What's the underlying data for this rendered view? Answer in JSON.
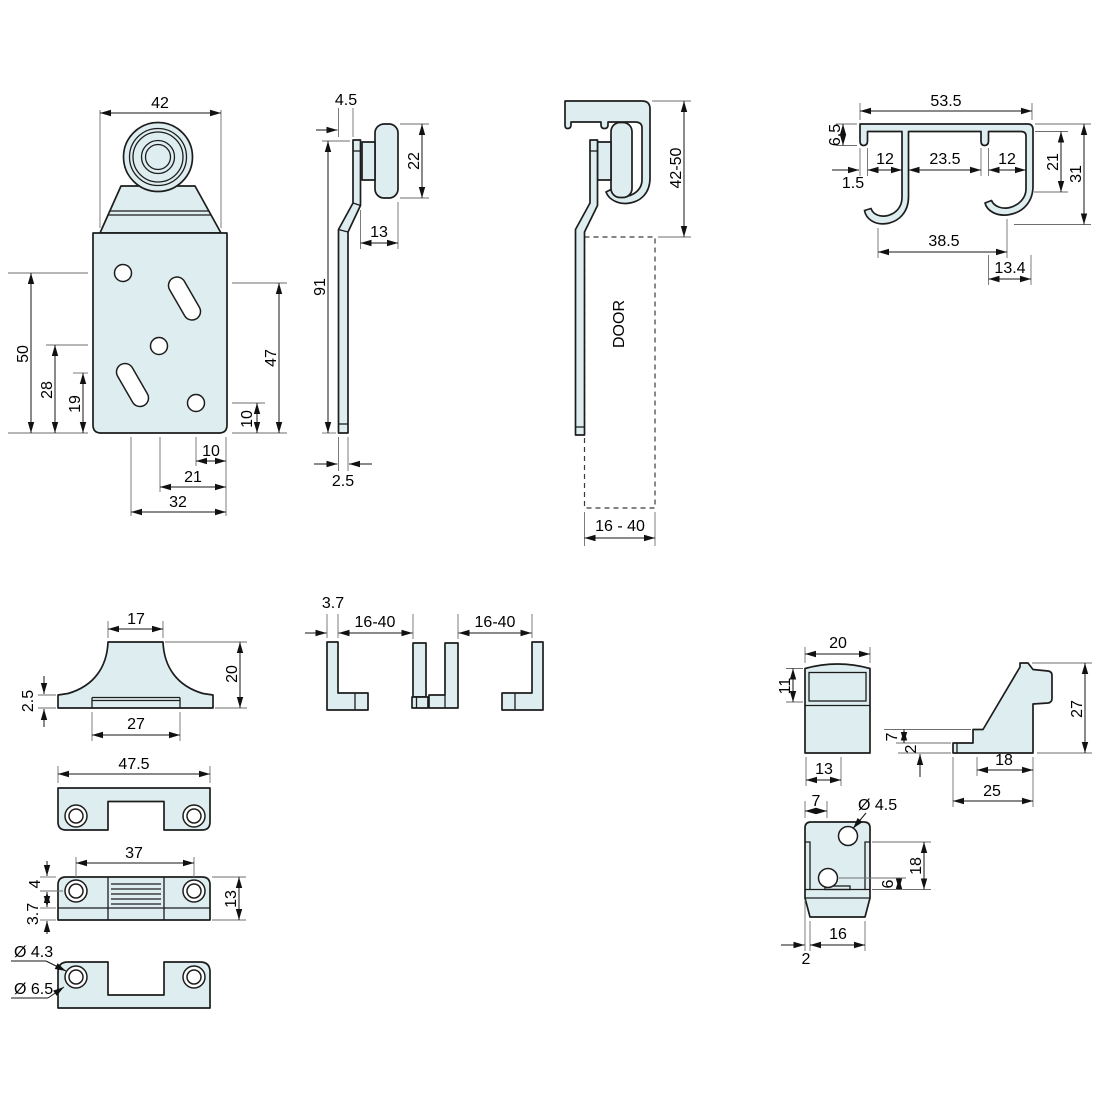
{
  "title": "Sliding door hardware dimensioned drawing",
  "colors": {
    "part_fill": "#deeef0",
    "outline": "#1d1d1d",
    "dim": "#161616",
    "ext": "#6e6e6e",
    "background": "#ffffff"
  },
  "labels": {
    "p1": {
      "w42": "42",
      "h50": "50",
      "h28": "28",
      "h19": "19",
      "h47": "47",
      "h10": "10",
      "b10": "10",
      "b21": "21",
      "b32": "32"
    },
    "p2": {
      "d45": "4.5",
      "d22": "22",
      "d13": "13",
      "d91": "91",
      "d25": "2.5"
    },
    "p3": {
      "h": "42-50",
      "door": "DOOR",
      "w": "16 - 40"
    },
    "p4": {
      "w": "53.5",
      "lip": "6.5",
      "s1": "12",
      "s2": "23.5",
      "s3": "12",
      "t": "1.5",
      "h21": "21",
      "h31": "31",
      "span": "38.5",
      "hook": "13.4"
    },
    "p5": {
      "top": "17",
      "h": "20",
      "lip": "2.5",
      "groove": "27"
    },
    "p6": {
      "w": "47.5"
    },
    "p7": {
      "holes": "37",
      "top": "4",
      "strip": "3.7",
      "h": "13"
    },
    "p8": {
      "inner": "Ø 4.3",
      "outer": "Ø 6.5"
    },
    "p9": {
      "t": "3.7",
      "r1": "16-40",
      "r2": "16-40"
    },
    "p10": {
      "w": "20",
      "panel": "11",
      "base": "13"
    },
    "p11": {
      "h": "27",
      "d18": "18",
      "d25": "25",
      "step": "7",
      "foot": "2"
    },
    "p12": {
      "off": "7",
      "dia": "Ø 4.5",
      "h18": "18",
      "h6": "6",
      "w16": "16",
      "lip": "2"
    }
  }
}
